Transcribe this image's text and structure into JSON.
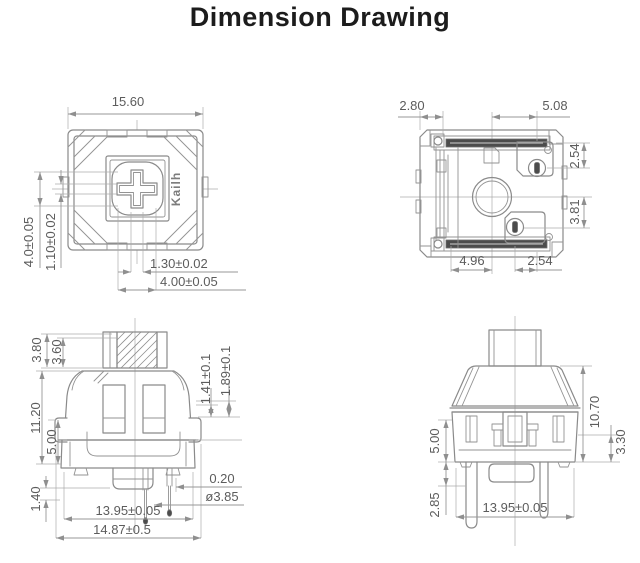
{
  "title": "Dimension Drawing",
  "brand": "Kailh",
  "colors": {
    "line": "#8a8a8a",
    "dimension_text": "#5c5c5c",
    "title_text": "#1c1c1c",
    "pin_fill": "#4c4c4c"
  },
  "views": {
    "top_view": {
      "dims": {
        "overall_width": "15.60",
        "height_a": "4.0±0.05",
        "height_b": "1.10±0.02",
        "slot_width": "1.30±0.02",
        "cross_width": "4.00±0.05"
      }
    },
    "bottom_view": {
      "dims": {
        "left_offset": "2.80",
        "pin_pitch": "5.08",
        "pin_top": "2.54",
        "pin_mid": "3.81",
        "bottom_left": "4.96",
        "bottom_right": "2.54"
      }
    },
    "front_view": {
      "dims": {
        "stem_full": "3.80",
        "stem_travel": "3.60",
        "body_height": "11.20",
        "lower_height": "5.00",
        "foot": "1.40",
        "step_a": "1.41±0.1",
        "step_b": "1.89±0.1",
        "pin_offset": "0.20",
        "boss_diameter": "ø3.85",
        "base_width": "13.95±0.05",
        "overall_width": "14.87±0.5"
      }
    },
    "side_view": {
      "dims": {
        "lower_height": "5.00",
        "pin_depth": "2.85",
        "body_height": "10.70",
        "skirt": "3.30",
        "base_width": "13.95±0.05"
      }
    }
  }
}
